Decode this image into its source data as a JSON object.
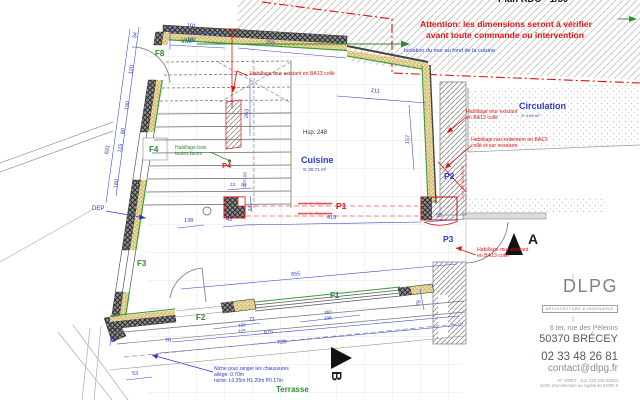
{
  "header": {
    "plan_title": "Plan RDC - 1/50",
    "warning_line1": "Attention: les dimensions seront à vérifier",
    "warning_line2": "avant toute commande ou intervention"
  },
  "notes": {
    "isolation": "Isolation du mur au fond de la cuisine",
    "habillage_top": "Habillage mur existant en BA13 collé",
    "habillage_right_l1": "Habillage mur existant",
    "habillage_right_l2": "en BA13 collé",
    "raccord_l1": "Habillage raccordement en BA13",
    "raccord_l2": "collé et sur ossature",
    "habillage_low_l1": "Habillage mur existant",
    "habillage_low_l2": "en BA13 collé",
    "joint": "Joint de dilatation",
    "habillage_bois_l1": "Habillage bois",
    "habillage_bois_l2": "toutes faces",
    "niche_l1": "Niche pour ranger les chaussures",
    "niche_l2": "allège: 0.70m",
    "niche_l3": "niche: L0.35m H1.20m P0.17m"
  },
  "rooms": {
    "cuisine": "Cuisine",
    "cuisine_area": "S: 26.71 m²",
    "cuisine_height": "Hsp: 248",
    "circulation": "Circulation",
    "circulation_area": "S: 4.58 m²",
    "terrasse": "Terrasse"
  },
  "marks": {
    "f1": "F1",
    "f2": "F2",
    "f3": "F3",
    "f4": "F4",
    "f8": "F8",
    "p1": "P1",
    "p2": "P2",
    "p3": "P3",
    "p4": "P4",
    "dep": "DEP",
    "vmp": "VMP",
    "section_a": "A",
    "section_b": "B"
  },
  "dims": [
    "101",
    "107",
    "255",
    "211",
    "157",
    "263",
    "34",
    "120",
    "190",
    "80",
    "115",
    "160",
    "631",
    "419",
    "43",
    "95",
    "23",
    "20",
    "44",
    "117/100",
    "655",
    "675",
    "728",
    "71",
    "100",
    "225",
    "70",
    "53",
    "59",
    "360",
    "336",
    "78",
    "138"
  ],
  "title_block": {
    "logo": "DLPG",
    "logo_sub": "ARCHITECTURE & INGÉNIERIE",
    "address_line1": "6 ter, rue des Pèlerins",
    "address_line2": "50370 BRÉCEY",
    "phone": "02 33 48 26 81",
    "email": "contact@dlpg.fr",
    "siret": "N° SIRET : 511 238 248 00054",
    "company": "SARL d'architecture au capital de 24000 €"
  },
  "colors": {
    "dimension_blue": "#2a3bc8",
    "annotation_red": "#e01212",
    "green_label": "#2e8b2e",
    "warning_red": "#e81313",
    "insulation_tan": "#e6d49c"
  }
}
